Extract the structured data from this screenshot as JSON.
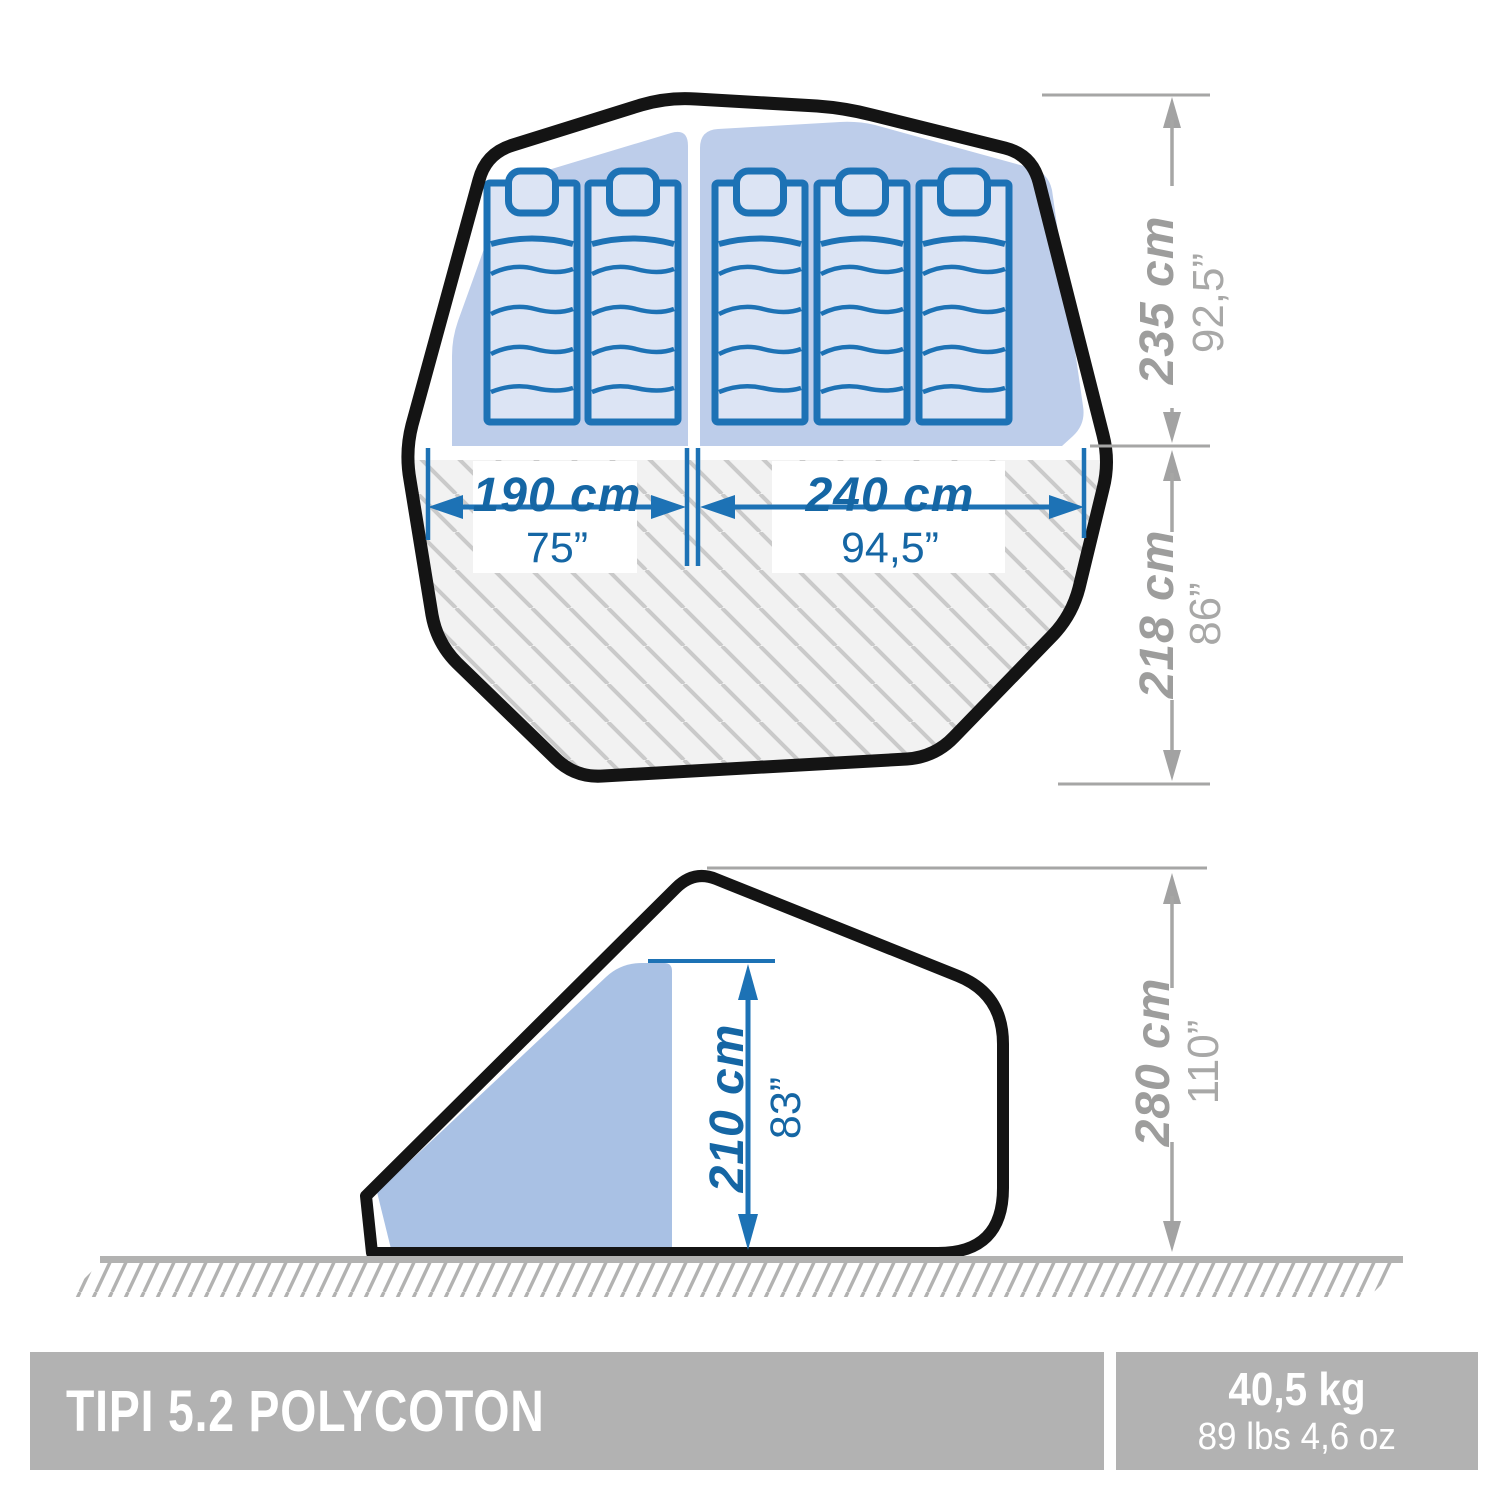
{
  "top_view": {
    "bedroom_left": {
      "width_cm": "190 cm",
      "width_in": "75”"
    },
    "bedroom_right": {
      "width_cm": "240 cm",
      "width_in": "94,5”"
    },
    "sleeping_depth": {
      "cm": "235 cm",
      "in": "92,5”"
    },
    "living_depth": {
      "cm": "218 cm",
      "in": "86”"
    },
    "mattress_count_left": 2,
    "mattress_count_right": 3
  },
  "side_view": {
    "interior_height": {
      "cm": "210 cm",
      "in": "83”"
    },
    "total_height": {
      "cm": "280 cm",
      "in": "110”"
    }
  },
  "footer": {
    "product_name": "TIPI 5.2 POLYCOTON",
    "weight_metric": "40,5 kg",
    "weight_imperial": "89 lbs 4,6 oz"
  },
  "colors": {
    "outline_black": "#141414",
    "dimension_blue": "#1d72b5",
    "text_blue": "#1566a4",
    "dimension_gray": "#a2a2a2",
    "bedroom_fill": "#bdcdea",
    "cabin_fill": "#a9c1e4",
    "mattress_fill": "#dce4f4",
    "floor_hatch_bg": "#f2f2f2",
    "footer_gray": "#b2b2b2"
  }
}
